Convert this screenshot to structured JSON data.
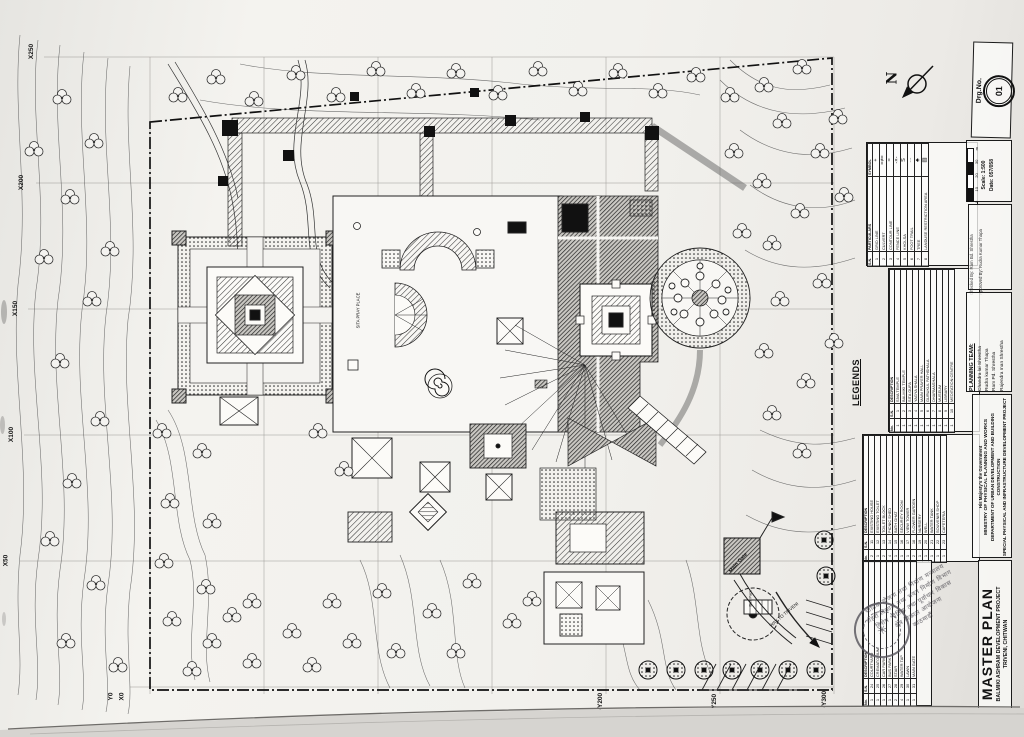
{
  "sheet": {
    "drg": {
      "label": "Drg.No.",
      "value": "01"
    },
    "scale": {
      "ticks": [
        "0",
        "10",
        "20",
        "30"
      ],
      "unit": "m",
      "scale_text": "Scale: 1:500",
      "date_text": "Date: 057/058"
    },
    "north_label": "N",
    "signoff": {
      "checked": "Checked By: Ram Bd. Shrestha",
      "approved": "Approved By: Rudra Kumar Thapa"
    }
  },
  "title_block": {
    "government": "His Majesty's the Government",
    "ministry": "MINISTRY OF PHYSICAL PLANNING AND WORKS",
    "department": "DEPARTMENT OF URBAN DEVELOPMENT AND BUILDING CONSTRUCTION",
    "agency": "SPECIAL PHYSICAL AND INFRASTRUCTURE DEVELOPMENT PROJECT",
    "title": "MASTER PLAN",
    "project": "BALMIKI ASHRAM DEVELOPMENT PROJECT",
    "location": "TRIVENI, CHITWAN"
  },
  "planning_team": {
    "heading": "PLANNING TEAM:",
    "members": [
      "Chandra lal Shrestha",
      "Rudra kumar Thapa",
      "Ram Pd. Shrestha",
      "Rajendra man Shrestha"
    ]
  },
  "legends": {
    "heading": "LEGENDS",
    "symbol_table": {
      "sn_h": "S.N.",
      "part_h": "PARTICULARS",
      "sym_h": "SYMBOL",
      "rows": [
        {
          "sn": "1",
          "part": "GRID LINE",
          "sym": "+"
        },
        {
          "sn": "2",
          "part": "CULVERT",
          "sym": "=≠="
        },
        {
          "sn": "3",
          "part": "CONTOUR LINE",
          "sym": "≈"
        },
        {
          "sn": "4",
          "part": "FENCE LINE",
          "sym": "-×-"
        },
        {
          "sn": "5",
          "part": "KHOLSA",
          "sym": "S"
        },
        {
          "sn": "6",
          "part": "FOOT TRAIL",
          "sym": "···"
        },
        {
          "sn": "7",
          "part": "TREE",
          "sym": "♣"
        },
        {
          "sn": "8",
          "part": "LANDUSE RESTRICTION AREA",
          "sym": "▨"
        }
      ]
    },
    "facility_headers": {
      "no": "No.",
      "sn": "S.N.",
      "desc": "DESCRIPTION"
    },
    "facility_bands": [
      [
        {
          "no": "1",
          "sn": "1",
          "desc": "SIVA TEMPLE"
        },
        {
          "no": "1",
          "sn": "2",
          "desc": "BALMIKI TEMPLE"
        },
        {
          "no": "1",
          "sn": "3",
          "desc": "SITA GUFA"
        },
        {
          "no": "1",
          "sn": "4",
          "desc": "YAGYA SHALA"
        },
        {
          "no": "1",
          "sn": "5",
          "desc": "MAIN PRAYER HALL"
        },
        {
          "no": "1",
          "sn": "6",
          "desc": "GURUKUL PATHSHALA"
        },
        {
          "no": "1",
          "sn": "7",
          "desc": "DHARMASHALA"
        },
        {
          "no": "1",
          "sn": "8",
          "desc": "MUSEUM"
        },
        {
          "no": "1",
          "sn": "9",
          "desc": "LIBRARY"
        },
        {
          "no": "1",
          "sn": "10",
          "desc": "MEDITATION CENTRE"
        }
      ],
      [
        {
          "no": "2",
          "sn": "11",
          "desc": "EXISTING HOUSE"
        },
        {
          "no": "1",
          "sn": "12",
          "desc": "EXISTING TOILET"
        },
        {
          "no": "2",
          "sn": "13",
          "desc": "TOILET BLOCK"
        },
        {
          "no": "4",
          "sn": "14",
          "desc": "PICNIC SHED"
        },
        {
          "no": "1",
          "sn": "15",
          "desc": "BATH GHAT"
        },
        {
          "no": "1",
          "sn": "16",
          "desc": "SECURITY ROOM"
        },
        {
          "no": "1",
          "sn": "17",
          "desc": "VIEW TOWER"
        },
        {
          "no": "2",
          "sn": "18",
          "desc": "FLOWER GARDEN"
        },
        {
          "no": "1",
          "sn": "19",
          "desc": "NURSERY"
        },
        {
          "no": "1",
          "sn": "20",
          "desc": "WELL"
        },
        {
          "no": "1",
          "sn": "21",
          "desc": "WATER TANK"
        },
        {
          "no": "1",
          "sn": "22",
          "desc": "SOUVENIR SHOP"
        },
        {
          "no": "1",
          "sn": "23",
          "desc": "CAFETERIA"
        }
      ],
      [
        {
          "no": "1",
          "sn": "24",
          "desc": "COURTYARD"
        },
        {
          "no": "1",
          "sn": "25",
          "desc": "CREMATORIUM"
        },
        {
          "no": "1",
          "sn": "26",
          "desc": "CAR PARK"
        },
        {
          "no": "1",
          "sn": "27",
          "desc": "BUS PARK"
        },
        {
          "no": "2",
          "sn": "28",
          "desc": "STAIR"
        },
        {
          "no": "4",
          "sn": "29",
          "desc": "WATER TAP"
        },
        {
          "no": "1",
          "sn": "30",
          "desc": "LAWN"
        },
        {
          "no": "1",
          "sn": "31",
          "desc": "MAIN GATE"
        }
      ]
    ]
  },
  "plan": {
    "grid_left": [
      "X250",
      "X200",
      "X150",
      "X100",
      "X50"
    ],
    "corner": [
      "Y0",
      "X0"
    ],
    "grid_bottom": [
      "-Y200",
      "-Y250",
      "-Y300"
    ],
    "labels": {
      "pray": "SITA PRAY PLACE",
      "gate": "Main Gate",
      "road": "WAY TO TRIVENI",
      "bus": "Bus Park"
    }
  },
  "stamp": {
    "lines": [
      {
        "t": "भौतिक योजना तथा निर्माण मन्त्रालय"
      },
      {
        "t": "शहरी विकास तथा भवन निर्माण विभाग"
      },
      {
        "t": "विशेष भौतिक तथा पूर्वाधार विकास"
      },
      {
        "t": "क्षेत्र विकास आयोजना"
      },
      {
        "t": "काठमाडौं"
      }
    ]
  }
}
